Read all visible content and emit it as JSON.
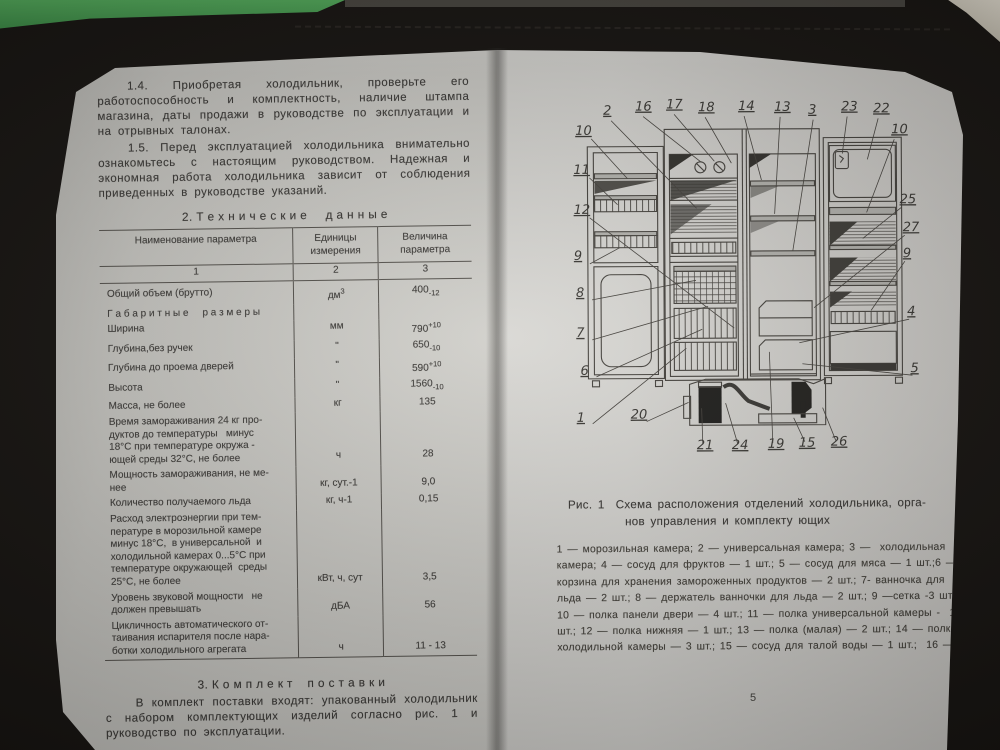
{
  "colors": {
    "case": "#161310",
    "green_surface": "#46a14f",
    "page_paper": "#d3d2cd",
    "ink": "#3d3b38"
  },
  "left_page": {
    "para_1_4": "1.4. Приобретая холодильник, проверьте его работоспособность и комплектность, наличие штампа магазина, даты продажи в руководстве по эксплуатации и на отрывных талонах.",
    "para_1_5": "1.5. Перед эксплуатацией холодильника внимательно ознакомьтесь с настоящим руководством. Надежная и экономная работа холодильника зависит от соблюдения приведенных в руководстве указаний.",
    "section2_title": "2. Т е х н и ч е с к и е     д а н н ы е",
    "table": {
      "headers": {
        "name": "Наименование параметра",
        "units": "Единицы\nизмерения",
        "value": "Величина\nпараметра"
      },
      "col_numbers": [
        "1",
        "2",
        "3"
      ],
      "rows": [
        {
          "name": "Общий объем (брутто)",
          "unit": "дм",
          "unit_sup": "3",
          "val": "400",
          "tol": "-12",
          "tol_pos": "sub"
        },
        {
          "name": "Г а б а р и т н ы е     р а з м е р ы",
          "unit": "",
          "val": ""
        },
        {
          "name": "Ширина",
          "unit": "мм",
          "val": "790",
          "tol": "+10",
          "tol_pos": "sup"
        },
        {
          "name": "Глубина,без ручек",
          "unit": "\"",
          "val": "650",
          "tol": "-10",
          "tol_pos": "sub"
        },
        {
          "name": "Глубина до проема дверей",
          "unit": "\"",
          "val": "590",
          "tol": "+10",
          "tol_pos": "sup"
        },
        {
          "name": "Высота",
          "unit": "\"",
          "val": "1560",
          "tol": "-10",
          "tol_pos": "sub"
        },
        {
          "name": "Масса, не более",
          "unit": "кг",
          "val": "135"
        },
        {
          "name": "Время замораживания 24 кг про-\nдуктов до температуры   минус\n18°С при температуре окружа -\nющей среды 32°С, не более",
          "unit": "ч",
          "val": "28"
        },
        {
          "name": "Мощность замораживания, не ме-\nнее",
          "unit": "кг, сут.-1",
          "val": "9,0"
        },
        {
          "name": "Количество получаемого льда",
          "unit": "кг, ч-1",
          "val": "0,15"
        },
        {
          "name": "Расход электроэнергии при тем-\nпературе в морозильной камере\nминус 18°С,  в универсальной  и\nхолодильной камерах 0...5°С при\nтемпературе окружающей  среды\n25°С, не более",
          "unit": "кВт, ч, сут",
          "val": "3,5"
        },
        {
          "name": "Уровень звуковой мощности   не\nдолжен превышать",
          "unit": "дБА",
          "val": "56"
        },
        {
          "name": "Цикличность автоматического от-\nтаивания испарителя после нара-\nботки холодильного агрегата",
          "unit": "ч",
          "val": "11 - 13"
        }
      ]
    },
    "section3_title": "3. К о м п л е к т    п о с т а в к и",
    "para_3": "В комплект поставки входят: упакованный холодильник с набором комплектующих изделий согласно рис. 1 и руководство по эксплуатации.",
    "page_number": "4"
  },
  "right_page": {
    "figure": {
      "callouts_top": [
        "2",
        "16",
        "17",
        "18",
        "14",
        "13",
        "3",
        "23",
        "22"
      ],
      "callouts_left": [
        "10",
        "11",
        "12",
        "9",
        "8",
        "7",
        "6",
        "1",
        "20"
      ],
      "callouts_right": [
        "10",
        "25",
        "27",
        "9",
        "4",
        "5"
      ],
      "callouts_bottom": [
        "21",
        "24",
        "19",
        "15",
        "26"
      ]
    },
    "caption": "Рис. 1  Схема расположения отделений холодильника, орга-\nнов управления и комплекту ющих",
    "legend": "1 — морозильная камера; 2 — универсальная камера; 3 —  холодильная\nкамера; 4 — сосуд для фруктов — 1 шт.; 5 — сосуд для мяса — 1 шт.;6 —\nкорзина для хранения замороженных продуктов — 2 шт.; 7- ванночка для\nльда — 2 шт.; 8 — держатель ванночки для льда — 2 шт.; 9 —сетка -3 шт.;\n10 — полка панели двери — 4 шт.; 11 — полка универсальной камеры -  1\nшт.; 12 — полка нижняя — 1 шт.; 13 — полка (малая) — 2 шт.; 14 — полка\nхолодильной камеры — 3 шт.; 15 — сосуд для талой воды — 1 шт.;  16 —",
    "page_number": "5"
  }
}
